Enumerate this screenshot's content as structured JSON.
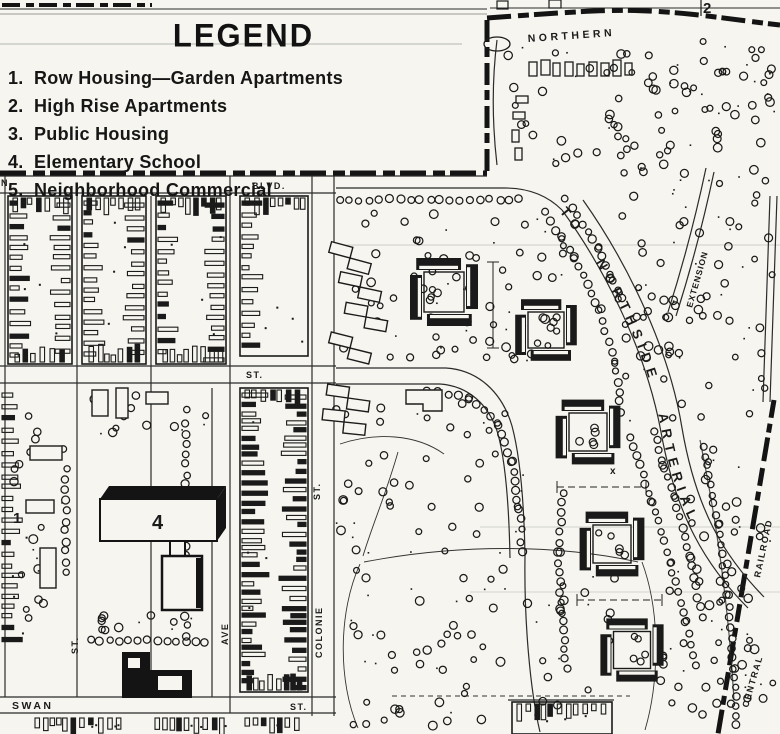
{
  "legend": {
    "title": "LEGEND",
    "items": [
      {
        "num": "1.",
        "label": "Row Housing—Garden Apartments"
      },
      {
        "num": "2.",
        "label": "High Rise Apartments"
      },
      {
        "num": "3.",
        "label": "Public Housing"
      },
      {
        "num": "4.",
        "label": "Elementary School"
      },
      {
        "num": "5.",
        "label": "Neighborhood Commercial"
      }
    ]
  },
  "labels": {
    "blvd": "BLVD.",
    "st_top": "ST.",
    "n_edge": "N",
    "northern": "NORTHERN",
    "boundary_num": "2",
    "arterial": "TO NORTHSIDE ARTERIAL",
    "extension": "EXTENSION",
    "colonie_st": "ST.",
    "colonie": "COLONIE",
    "ave": "AVE",
    "st_left": "ST.",
    "swan": "SWAN",
    "st_bottom": "ST.",
    "central": "CENTRAL",
    "railroad": "RAILROAD",
    "block_num": "1",
    "school_num": "4",
    "x_mark": "x"
  },
  "colors": {
    "ink": "#181818",
    "paper": "#f6f5ef"
  }
}
